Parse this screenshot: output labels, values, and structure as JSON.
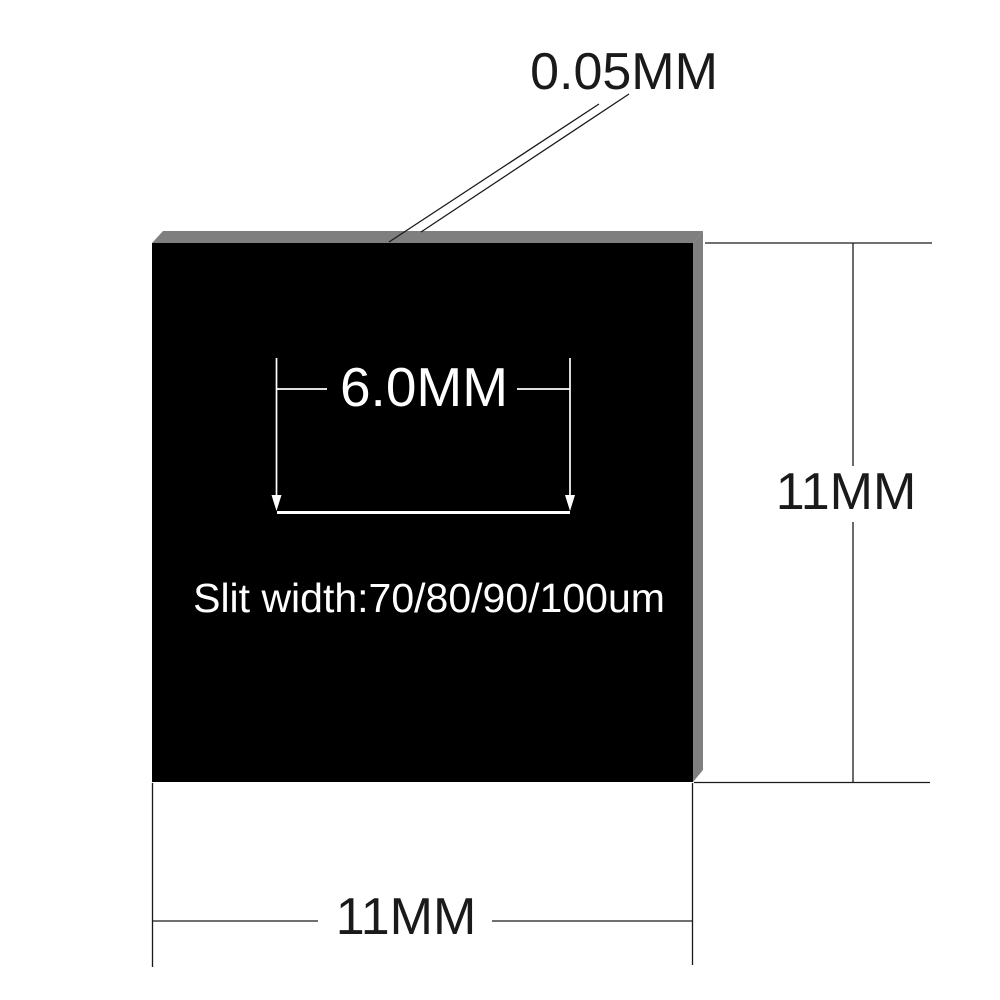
{
  "colors": {
    "background": "#ffffff",
    "plate": "#000000",
    "edge": "#7f7f7f",
    "ink": "#1a1a1a",
    "slit_ink": "#ffffff"
  },
  "labels": {
    "thickness": "0.05MM",
    "slit_length": "6.0MM",
    "slit_width": "Slit width:70/80/90/100um",
    "height": "11MM",
    "width": "11MM"
  }
}
